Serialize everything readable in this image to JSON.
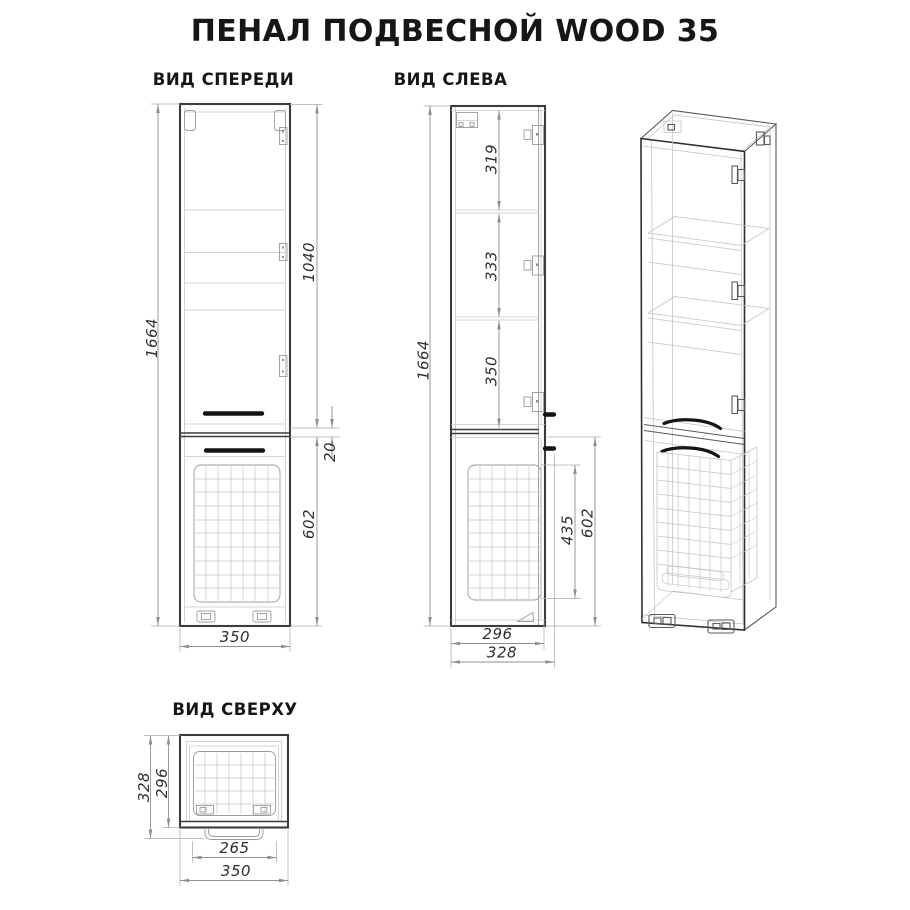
{
  "title": "ПЕНАЛ ПОДВЕСНОЙ WOOD 35",
  "front": {
    "label": "ВИД СПЕРЕДИ",
    "dims": {
      "height": "1664",
      "upper_door": "1040",
      "gap": "20",
      "lower_door": "602",
      "width": "350"
    }
  },
  "left": {
    "label": "ВИД СЛЕВА",
    "dims": {
      "height": "1664",
      "section_top": "319",
      "section_mid": "333",
      "section_bottom": "350",
      "basket": "435",
      "lower_door": "602",
      "depth_body": "296",
      "depth_total": "328"
    }
  },
  "top": {
    "label": "ВИД СВЕРХУ",
    "dims": {
      "depth_total": "328",
      "depth_body": "296",
      "handle": "265",
      "width": "350"
    }
  },
  "colors": {
    "background": "#ffffff",
    "line_dark": "#3c3c3c",
    "line_medium": "#9b9b9b",
    "line_light": "#c7c7c7",
    "dimension": "#8f8f8f",
    "handle": "#141414",
    "text": "#2f2f2f",
    "heading": "#161616"
  }
}
